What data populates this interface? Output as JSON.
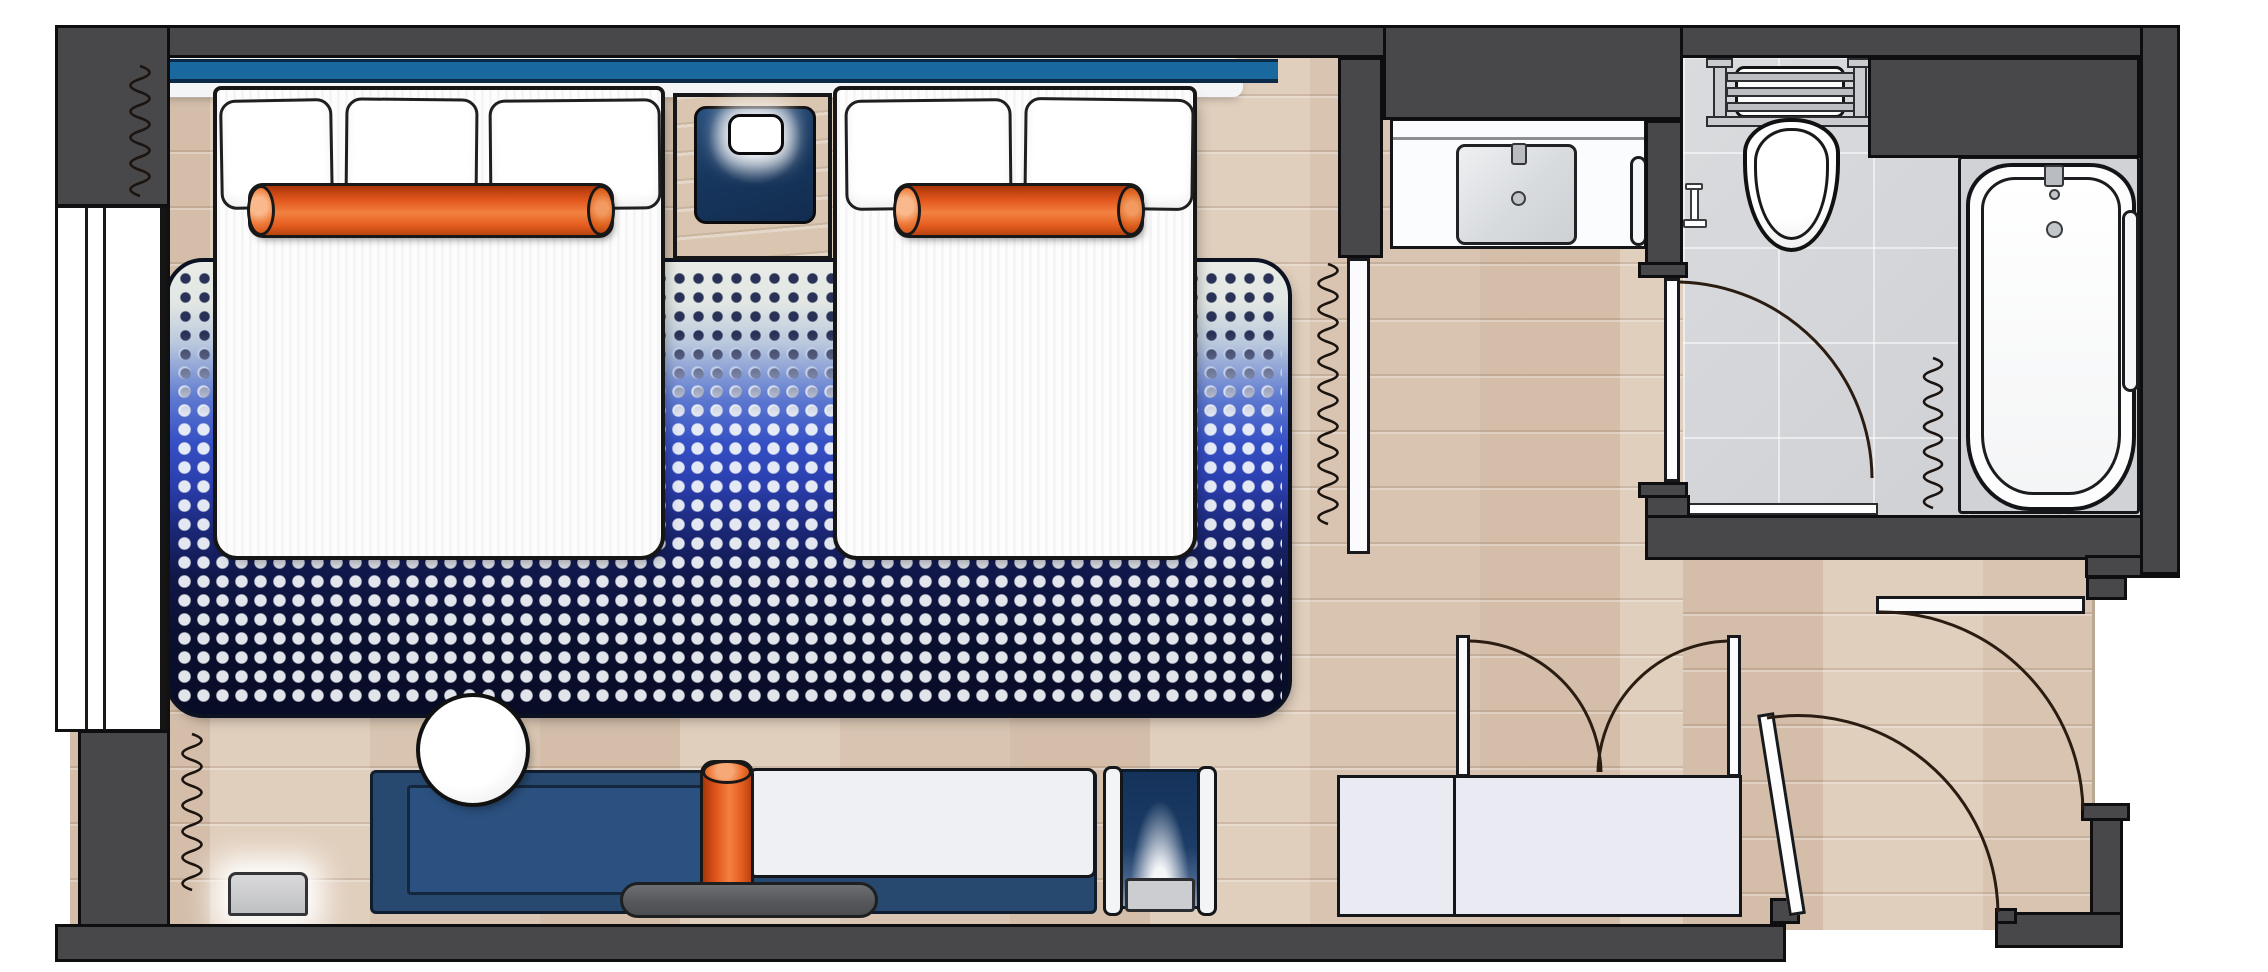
{
  "meta": {
    "title": "Hotel guest room floor plan",
    "view": "top-down architectural plan",
    "visible_text": "none"
  },
  "colors": {
    "wall_fill": "#48484a",
    "outline": "#0e0e10",
    "wood_floor": "#dccab8",
    "tile_floor": "#d4d6d9",
    "headboard_blue": "#19689e",
    "navy_accent": "#17375f",
    "rug_blue": "#3550c4",
    "rug_dark_navy": "#0a0f2e",
    "bolster_orange": "#e65d20",
    "cushion_white": "#eef0f4"
  },
  "rooms": [
    {
      "name": "bedroom",
      "floor": "wood"
    },
    {
      "name": "entry-hall",
      "floor": "wood"
    },
    {
      "name": "vanity-nook",
      "floor": "wood"
    },
    {
      "name": "bathroom",
      "floor": "gray-tile"
    }
  ],
  "items": {
    "window": "Full-height window on left exterior wall",
    "curtain_left_top": "Drapery coil symbol, window top",
    "curtain_left_bottom": "Drapery coil symbol, window bottom",
    "headboard": "Shared blue headboard wall panel",
    "bed_1": "Bed with three pillows and long orange bolster",
    "bed_2": "Bed with two pillows and orange bolster",
    "nightstand": "Nightstand with glowing lamp on navy tray",
    "rug": "Blue gradient dotted area rug under beds",
    "sofa": "Navy upholstered sofa / daybed platform",
    "chaise_cushion": "White chaise cushion",
    "bolster_sofa": "Vertical orange bolster on sofa",
    "side_table": "Round white side table",
    "gray_bench": "Gray bench rail at sofa front",
    "luggage_rack": "Folding luggage rack with navy straps",
    "vent": "Wall unit vent at window sill",
    "closet": "Closet with double swing doors",
    "entry_door": "Entry door with swing arc",
    "connecting_door": "Connecting door below bathroom",
    "privacy_panel": "Sliding privacy panel with curtain coil",
    "vanity_counter": "Vanity counter with rectangular sink",
    "vanity_towel_bar": "Towel bar beside vanity",
    "bathroom_door": "Bathroom door with swing arc",
    "toilet": "Toilet with towel shelf above tank",
    "tp_holder": "Toilet paper holder",
    "bathtub": "Bathtub with faucet and drain",
    "tub_towel_bar": "Towel bar beside bathtub",
    "shower_curtain": "Shower curtain coil symbol"
  }
}
